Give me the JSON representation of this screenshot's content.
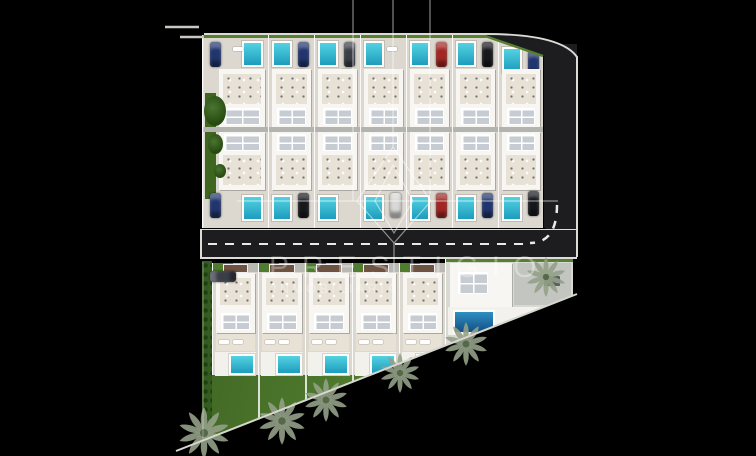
{
  "meta": {
    "description": "Aerial 3D site-plan render of a villa development with private pools, access roads, lawn and palm trees, over a black background, with a real-estate diamond-logo watermark"
  },
  "watermark": {
    "line1": "PRESTIGIO",
    "line2": "INMOBILIARIA"
  },
  "layout_counts": {
    "upper_row_villas": 7,
    "lower_row_villas_back_to_back": 7,
    "south_row_villas": 5,
    "corner_estate": 1,
    "palm_trees": 6,
    "parked_cars": 13
  },
  "palette": {
    "bg": "#000000",
    "asphalt": "#1d1d1f",
    "curb": "#dcdcd6",
    "ground": "#dcd8d0",
    "house": "#f7f6f3",
    "panel": "#c7ccd2",
    "terrace": "#e8e1d5",
    "divider": "#b3b3af",
    "pool": "#35bdd4",
    "poolDeep": "#1c5f9e",
    "deck": "#f2f1ec",
    "lawn": "#4f7c2e",
    "lawnDark": "#3f661f",
    "hedge": "#567f2f",
    "vine": "#355c20",
    "pavement": "#c3c6c0",
    "pergola": "#6e5242",
    "carNavy": "#20356e",
    "carRed": "#a32622",
    "carBlack": "#17181c",
    "carSilver": "#d8d8d6",
    "carDark": "#3a3f47",
    "palm": "#93a087",
    "palmDark": "#55684a",
    "watermark": "rgba(255,255,255,0.52)"
  }
}
